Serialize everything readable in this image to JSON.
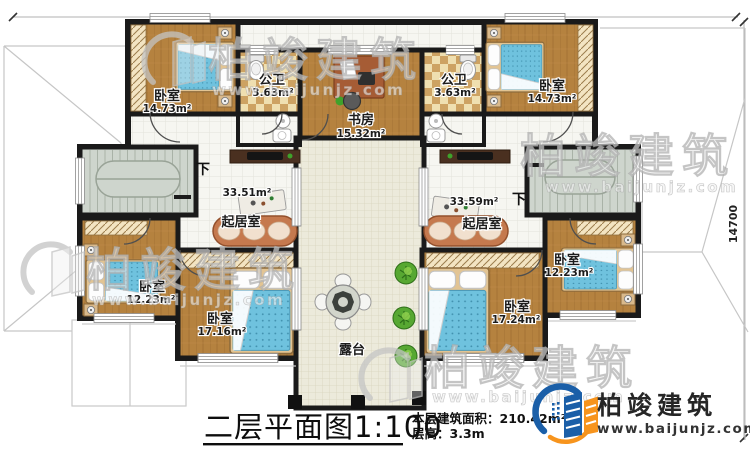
{
  "dimensions": {
    "width_label": "27750",
    "height_label": "14700"
  },
  "stairs": {
    "down_label": "下"
  },
  "rooms": [
    {
      "id": "bedroom-top-left",
      "name": "卧室",
      "area": "14.73m²"
    },
    {
      "id": "bath-left",
      "name": "公卫",
      "area": "3.63m²"
    },
    {
      "id": "study",
      "name": "书房",
      "area": "15.32m²"
    },
    {
      "id": "bath-right",
      "name": "公卫",
      "area": "3.63m²"
    },
    {
      "id": "bedroom-top-right",
      "name": "卧室",
      "area": "14.73m²"
    },
    {
      "id": "living-left",
      "name": "起居室",
      "area": "33.51m²"
    },
    {
      "id": "living-right",
      "name": "起居室",
      "area": "33.59m²"
    },
    {
      "id": "bedroom-left",
      "name": "卧室",
      "area": "12.23m²"
    },
    {
      "id": "bedroom-bottom-left",
      "name": "卧室",
      "area": "17.16m²"
    },
    {
      "id": "terrace",
      "name": "露台"
    },
    {
      "id": "bedroom-bottom-right",
      "name": "卧室",
      "area": "17.24m²"
    },
    {
      "id": "bedroom-right",
      "name": "卧室",
      "area": "12.23m²"
    }
  ],
  "title_block": {
    "title": "二层平面图",
    "scale": "1:100",
    "floor_area_label": "本层建筑面积：",
    "floor_area_value": "210.42m²",
    "floor_height_label": "层高：",
    "floor_height_value": "3.3m"
  },
  "logo": {
    "name": "柏竣建筑",
    "website": "www.baijunjz.com"
  },
  "watermark": {
    "text": "柏竣建筑",
    "subtext": "www.baijunjz.com"
  },
  "colors": {
    "wall": "#1a1a1a",
    "wood_floor": "#b5823f",
    "hall_tile": "#f6f6f1",
    "terrace_tile": "#eceadb",
    "stair": "#ced5cd",
    "mattress": "#6fc2de",
    "sofa": "#c5794e",
    "logo_blue": "#1b5fa8",
    "logo_orange": "#f7941d"
  }
}
